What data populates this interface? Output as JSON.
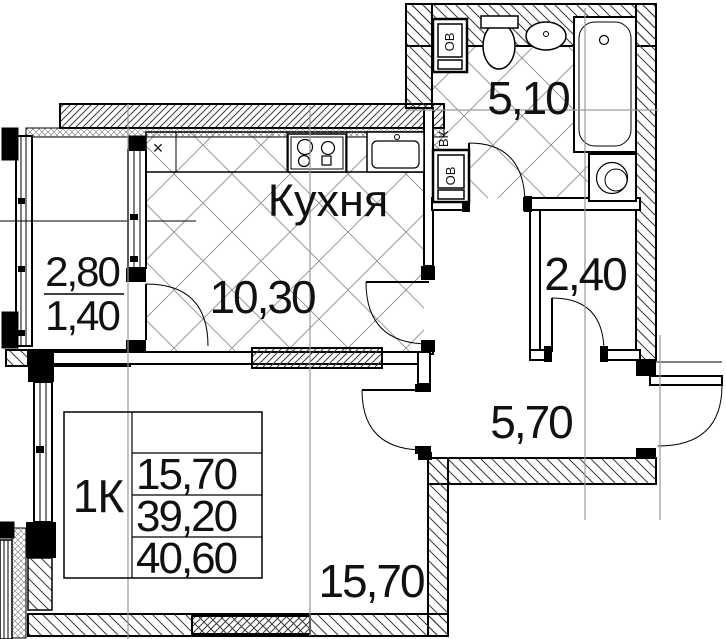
{
  "plan": {
    "labels": {
      "kitchen_name": "Кухня",
      "kitchen_area": "10,30",
      "bathroom_area": "5,10",
      "closet_area": "2,40",
      "hall_area": "5,70",
      "room_area": "15,70",
      "balcony_area_full": "2,80",
      "balcony_area_reduced": "1,40"
    },
    "info_table": {
      "flat_type": "1К",
      "values": [
        "15,70",
        "39,20",
        "40,60"
      ]
    },
    "risers": {
      "ov_top": "ОВ",
      "vk": "ВК",
      "ov_bottom": "ОВ"
    },
    "marks": {
      "counter_cross": "×"
    },
    "colors": {
      "line": "#000000",
      "axis": "#9a9a9a",
      "tile_grid": "#8d8d8d",
      "hatch": "#3a3a3a"
    }
  }
}
